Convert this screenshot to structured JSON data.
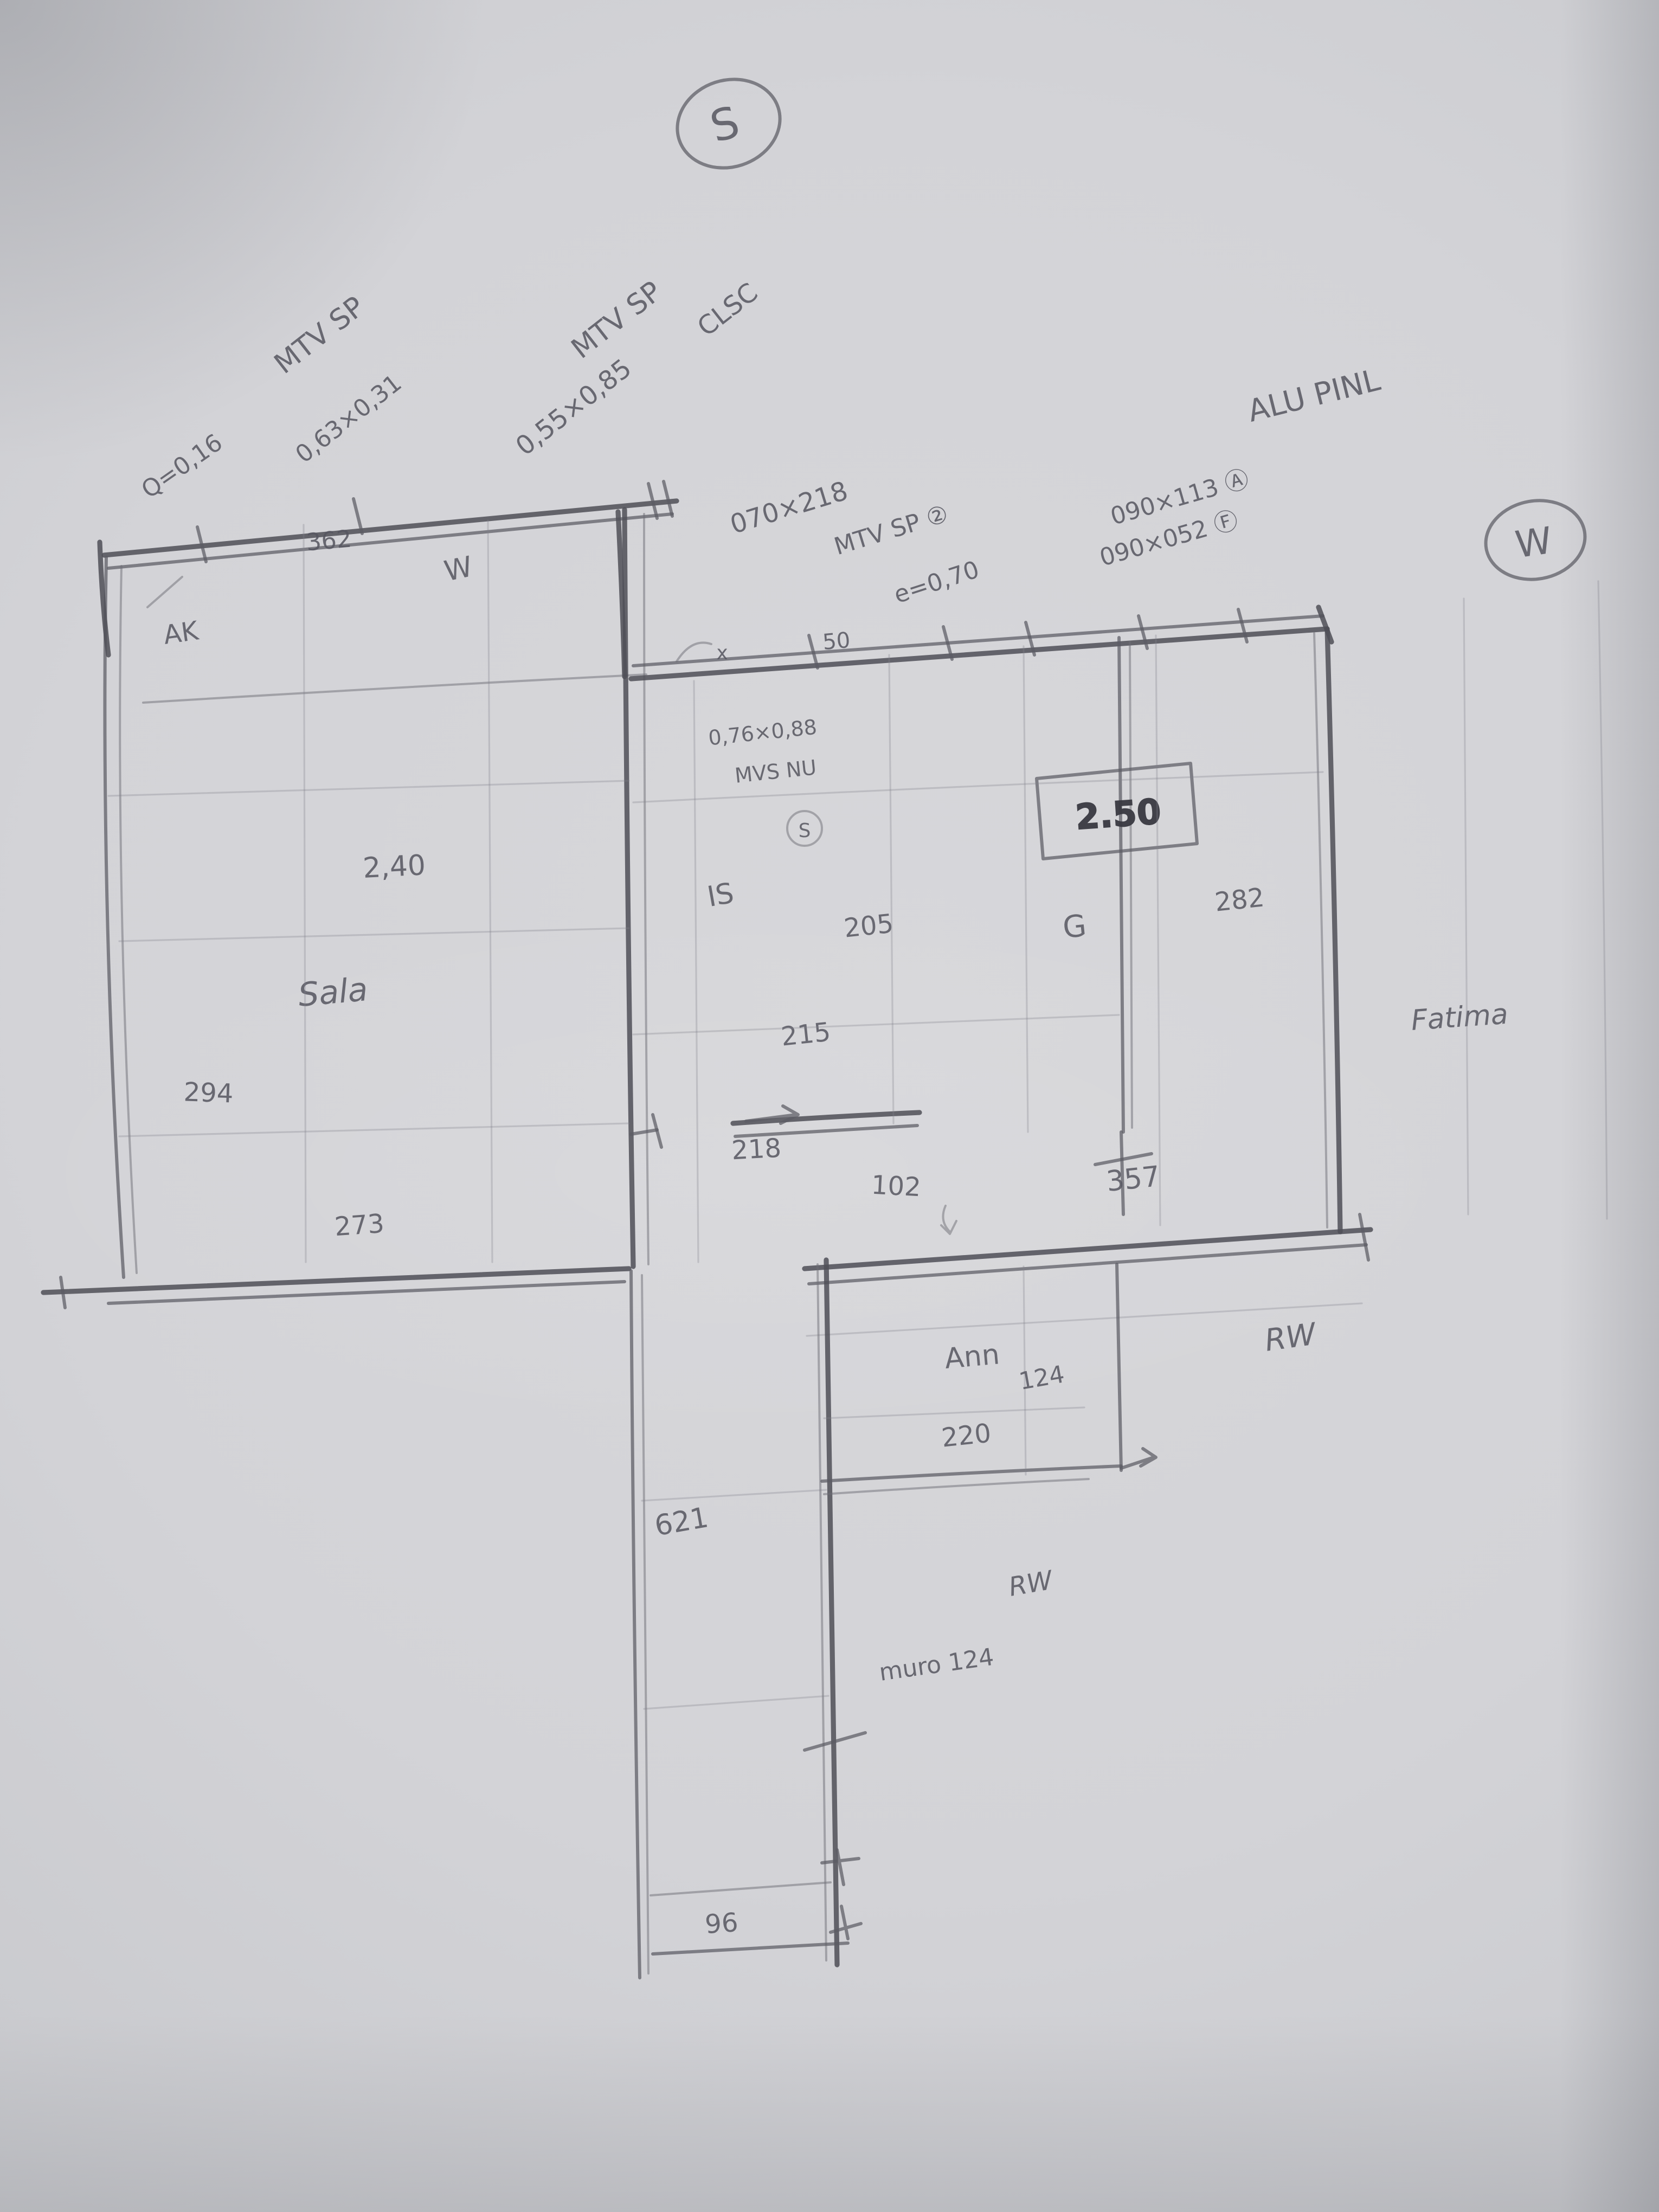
{
  "meta": {
    "kind": "hand-drawn pencil floor plan sketch on gray paper",
    "pencil_color": "#5c5c64",
    "paper_color": "#d3d3d7"
  },
  "t": {
    "compass_s": "S",
    "compass_w": "W",
    "tl_title": "MTV SP",
    "tl_q": "Q=0,16",
    "tl_dim": "0,63×0,31",
    "tm_title": "MTV SP",
    "tm_dim": "0,55×0,85",
    "tm_note": "CLSC",
    "door_dim": "070×218",
    "door_label": "MTV SP ②",
    "wall_e": "e=0,70",
    "tr_a": "090×113 Ⓐ",
    "tr_f": "090×052 Ⓕ",
    "tr_title": "ALU PINL",
    "dim_362": "362",
    "ak": "AK",
    "w_mark": "W",
    "mid_dim": "0,76×0,88",
    "mid_label": "MVS NU",
    "mid_mark": "S",
    "boxed": "2.50",
    "sala_h": "2,40",
    "sala": "Sala",
    "dim_294": "294",
    "dim_273": "273",
    "is": "IS",
    "dim_205": "205",
    "dim_215": "215",
    "dim_218": "218",
    "dim_102": "102",
    "dim_357": "357",
    "g_mark": "G",
    "dim_282": "282",
    "fatima": "Fatima",
    "ann": "Ann",
    "dim_124": "124",
    "dim_220": "220",
    "rw_upper": "RW",
    "rw_lower": "RW",
    "muro": "muro 124",
    "dim_621": "621",
    "dim_96": "96",
    "mark_x": "x",
    "mark_50": "50"
  }
}
